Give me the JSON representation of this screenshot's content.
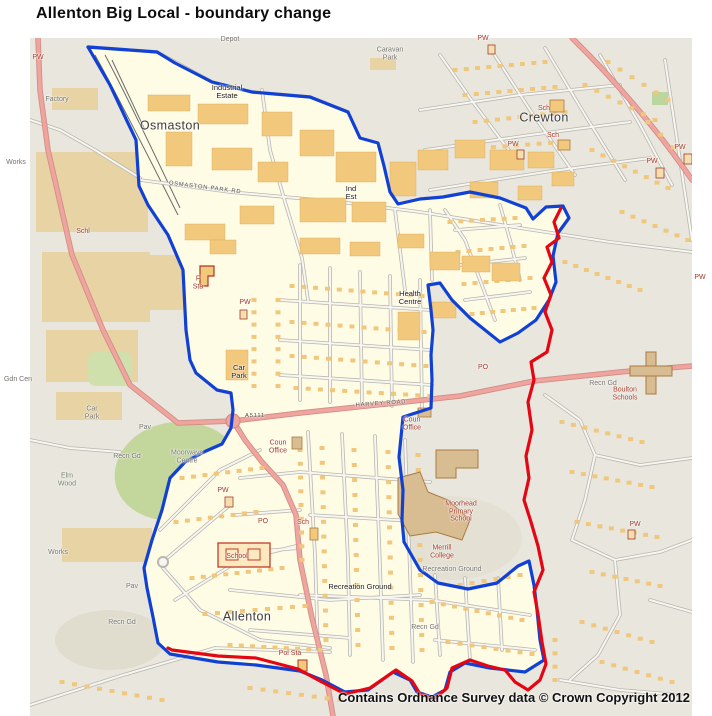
{
  "window": {
    "title": "Allenton Big Local - boundary change"
  },
  "map": {
    "attribution": "Contains Ordnance Survey data © Crown Copyright 2012",
    "colors": {
      "existing_boundary_blue": "#1141d4",
      "changed_boundary_red": "#e50613",
      "area_highlight_cream": "#fffce6",
      "map_background": "#e9e6de"
    },
    "labels": [
      {
        "text": "Osmaston",
        "x": 170,
        "y": 126,
        "kind": "place"
      },
      {
        "text": "Crewton",
        "x": 544,
        "y": 118,
        "kind": "place"
      },
      {
        "text": "Allenton",
        "x": 247,
        "y": 617,
        "kind": "place"
      },
      {
        "text": "Industrial\nEstate",
        "x": 227,
        "y": 92,
        "kind": "small"
      },
      {
        "text": "Ind\nEst",
        "x": 351,
        "y": 193,
        "kind": "small"
      },
      {
        "text": "Health\nCentre",
        "x": 410,
        "y": 298,
        "kind": "small"
      },
      {
        "text": "Car\nPark",
        "x": 239,
        "y": 372,
        "kind": "small"
      },
      {
        "text": "Car\nPark",
        "x": 92,
        "y": 413,
        "kind": "grey"
      },
      {
        "text": "Coun\nOffice",
        "x": 278,
        "y": 447,
        "kind": "red"
      },
      {
        "text": "Coun\nOffice",
        "x": 412,
        "y": 424,
        "kind": "red"
      },
      {
        "text": "Moorways\nCentre",
        "x": 187,
        "y": 457,
        "kind": "grey"
      },
      {
        "text": "Elm\nWood",
        "x": 67,
        "y": 480,
        "kind": "greygreen"
      },
      {
        "text": "Moorhead\nPrimary\nSchool",
        "x": 461,
        "y": 512,
        "kind": "red"
      },
      {
        "text": "Merrill\nCollege",
        "x": 442,
        "y": 552,
        "kind": "red"
      },
      {
        "text": "Recreation Ground",
        "x": 452,
        "y": 570,
        "kind": "grey"
      },
      {
        "text": "Recreation Ground",
        "x": 360,
        "y": 587,
        "kind": "small"
      },
      {
        "text": "Boulton\nSchools",
        "x": 625,
        "y": 394,
        "kind": "red"
      },
      {
        "text": "Recn Gd",
        "x": 603,
        "y": 384,
        "kind": "grey"
      },
      {
        "text": "Recn Gd",
        "x": 425,
        "y": 628,
        "kind": "grey"
      },
      {
        "text": "Recn Gd",
        "x": 127,
        "y": 457,
        "kind": "grey"
      },
      {
        "text": "Recn Gd",
        "x": 122,
        "y": 623,
        "kind": "grey"
      },
      {
        "text": "Works",
        "x": 58,
        "y": 553,
        "kind": "grey"
      },
      {
        "text": "Works",
        "x": 16,
        "y": 163,
        "kind": "grey"
      },
      {
        "text": "Factory",
        "x": 57,
        "y": 100,
        "kind": "grey"
      },
      {
        "text": "Schl",
        "x": 83,
        "y": 232,
        "kind": "red"
      },
      {
        "text": "Sch",
        "x": 544,
        "y": 109,
        "kind": "red"
      },
      {
        "text": "Sch",
        "x": 553,
        "y": 136,
        "kind": "red"
      },
      {
        "text": "Sch",
        "x": 303,
        "y": 523,
        "kind": "red"
      },
      {
        "text": "School",
        "x": 237,
        "y": 557,
        "kind": "red"
      },
      {
        "text": "Pol Sta",
        "x": 290,
        "y": 654,
        "kind": "red"
      },
      {
        "text": "F\nSta",
        "x": 198,
        "y": 283,
        "kind": "red"
      },
      {
        "text": "PW",
        "x": 38,
        "y": 58,
        "kind": "red"
      },
      {
        "text": "PW",
        "x": 245,
        "y": 303,
        "kind": "red"
      },
      {
        "text": "PW",
        "x": 223,
        "y": 491,
        "kind": "red"
      },
      {
        "text": "PW",
        "x": 483,
        "y": 39,
        "kind": "red"
      },
      {
        "text": "PW",
        "x": 513,
        "y": 145,
        "kind": "red"
      },
      {
        "text": "PW",
        "x": 652,
        "y": 162,
        "kind": "red"
      },
      {
        "text": "PW",
        "x": 680,
        "y": 148,
        "kind": "red"
      },
      {
        "text": "PW",
        "x": 700,
        "y": 278,
        "kind": "red"
      },
      {
        "text": "PW",
        "x": 635,
        "y": 525,
        "kind": "red"
      },
      {
        "text": "PO",
        "x": 263,
        "y": 522,
        "kind": "red"
      },
      {
        "text": "PO",
        "x": 483,
        "y": 368,
        "kind": "red"
      },
      {
        "text": "Pav",
        "x": 145,
        "y": 428,
        "kind": "grey"
      },
      {
        "text": "Pav",
        "x": 132,
        "y": 587,
        "kind": "grey"
      },
      {
        "text": "Depot",
        "x": 230,
        "y": 40,
        "kind": "grey"
      },
      {
        "text": "Caravan\nPark",
        "x": 390,
        "y": 54,
        "kind": "grey"
      },
      {
        "text": "Gdn Cen",
        "x": 18,
        "y": 380,
        "kind": "grey"
      },
      {
        "text": "HARVEY ROAD",
        "x": 381,
        "y": 404,
        "kind": "street",
        "rot": -4
      },
      {
        "text": "OSMASTON PARK RD",
        "x": 205,
        "y": 188,
        "kind": "street",
        "rot": 7
      },
      {
        "text": "A5111",
        "x": 255,
        "y": 416,
        "kind": "street"
      }
    ]
  }
}
